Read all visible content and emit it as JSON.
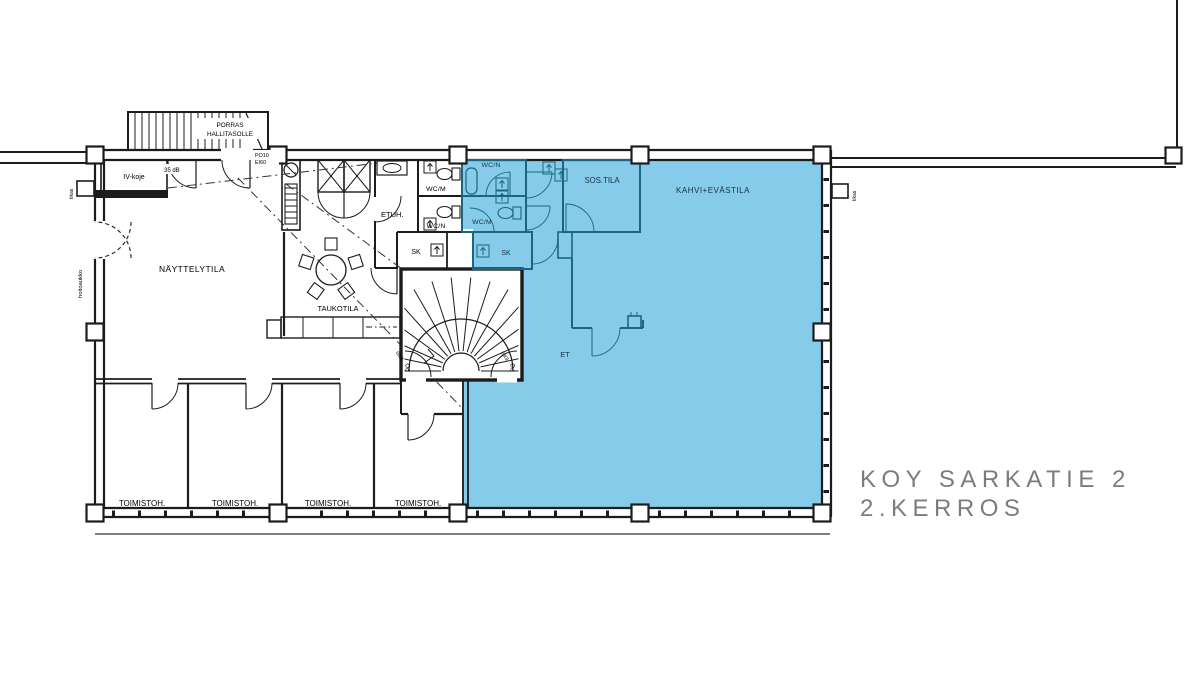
{
  "title": {
    "line1": "KOY SARKATIE 2",
    "line2": "2.KERROS"
  },
  "colors": {
    "highlight": "#86CCEA",
    "blue_wall": "#1A6680",
    "blue_text": "#14323F",
    "wall": "#1C1C1C",
    "title_text": "#7C7C7C"
  },
  "rooms": {
    "iv_koje": "IV-koje",
    "nayttelytila": "NÄYTTELYTILA",
    "taukotila": "TAUKOTILA",
    "etuh": "ETUH.",
    "wc_m_white": "WC/M",
    "wc_n_white": "WC/N",
    "sk_white": "SK",
    "wc_n_blue": "WC/N",
    "wc_m_blue": "WC/M",
    "sk_blue": "SK",
    "sos_tila": "SOS.TILA",
    "kahvi": "KAHVI+EVÄSTILA",
    "et": "ET"
  },
  "offices": [
    "TOIMISTOH.",
    "TOIMISTOH.",
    "TOIMISTOH.",
    "TOIMISTOH."
  ],
  "annotations": {
    "stair_ext_line1": "PORRAS",
    "stair_ext_line2": "HALLITASOLLE",
    "top_door_code": "PO10",
    "top_door_rating": "EI60",
    "acoustic_door": "35 dB",
    "ladder_left": "tikas",
    "ladder_right": "tikas",
    "service_hatch": "hoitoaukko",
    "stair_door_code": "PO",
    "stair_door_rating": "EI60"
  }
}
